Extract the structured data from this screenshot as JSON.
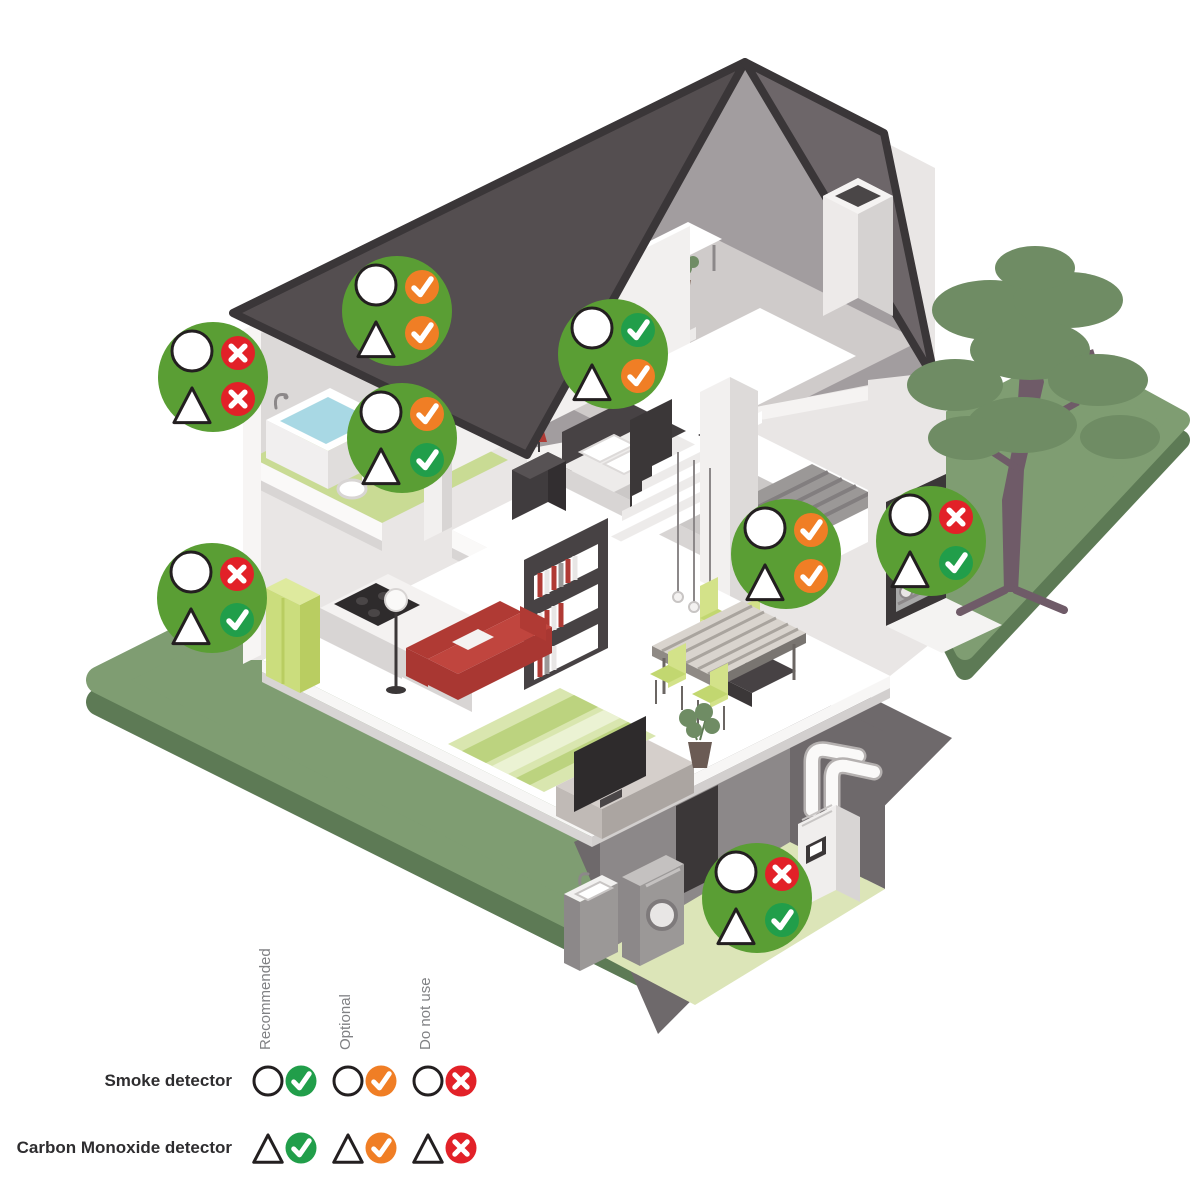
{
  "figure": {
    "description": "Isometric cutaway house showing where to place smoke and carbon monoxide detectors",
    "rooms_shown": [
      "attic office",
      "bathroom",
      "bedroom",
      "stair landing",
      "kitchen",
      "living room",
      "dining area",
      "garage",
      "basement laundry"
    ]
  },
  "badge_style": {
    "bg": "#5A9E34",
    "symbol_fill": "#FFFFFF",
    "symbol_stroke": "#231F20"
  },
  "legend": {
    "rows": [
      {
        "id": "smoke",
        "label": "Smoke detector",
        "symbol": "circle"
      },
      {
        "id": "co",
        "label": "Carbon Monoxide detector",
        "symbol": "triangle"
      }
    ],
    "columns": [
      {
        "id": "recommended",
        "label": "Recommended",
        "mark": "check",
        "color": "#219E4A"
      },
      {
        "id": "optional",
        "label": "Optional",
        "mark": "check",
        "color": "#F07E25"
      },
      {
        "id": "do_not_use",
        "label": "Do not use",
        "mark": "cross",
        "color": "#E22128"
      }
    ]
  },
  "badges": [
    {
      "room": "bathroom-eaves",
      "x": 213,
      "y": 377,
      "smoke": "do_not_use",
      "co": "do_not_use"
    },
    {
      "room": "attic",
      "x": 397,
      "y": 311,
      "smoke": "optional",
      "co": "optional"
    },
    {
      "room": "stair-landing",
      "x": 613,
      "y": 354,
      "smoke": "recommended",
      "co": "optional"
    },
    {
      "room": "bedroom",
      "x": 402,
      "y": 438,
      "smoke": "optional",
      "co": "recommended"
    },
    {
      "room": "kitchen",
      "x": 212,
      "y": 598,
      "smoke": "do_not_use",
      "co": "recommended"
    },
    {
      "room": "living-dining",
      "x": 786,
      "y": 554,
      "smoke": "optional",
      "co": "optional"
    },
    {
      "room": "garage",
      "x": 931,
      "y": 541,
      "smoke": "do_not_use",
      "co": "recommended"
    },
    {
      "room": "basement",
      "x": 757,
      "y": 898,
      "smoke": "do_not_use",
      "co": "recommended"
    }
  ],
  "legend_layout": {
    "row_y": [
      1081,
      1148
    ],
    "col_symbol_x": [
      268,
      348,
      428
    ],
    "col_mark_x": [
      301,
      381,
      461
    ],
    "header_center_x": [
      284,
      364,
      444
    ],
    "header_bottom_y": 1050,
    "label_right_x": 232
  }
}
